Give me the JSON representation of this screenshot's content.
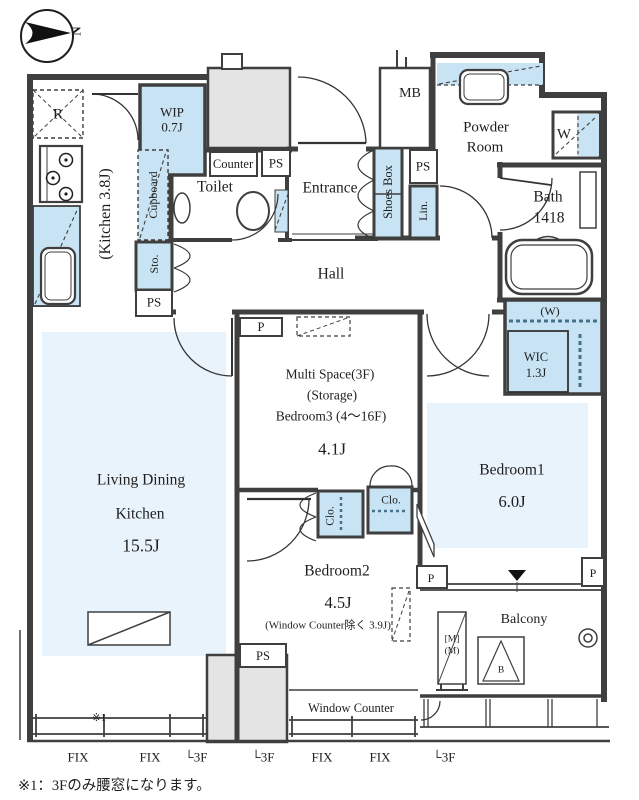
{
  "colors": {
    "wall": "#3f3f3f",
    "fixture_fill": "#c8e4f4",
    "room_fill": "#e9f3fb",
    "exterior_fill": "#e4e4e4",
    "bold_dash": "#46718a"
  },
  "compass": {
    "north_label": "N"
  },
  "labels": {
    "refrigerator": "R",
    "wip_name": "WIP",
    "wip_area": "0.7J",
    "kitchen": "(Kitchen 3.8J)",
    "cupboard": "Cupboard",
    "counter": "Counter",
    "ps_top": "PS",
    "ps_entrance": "PS",
    "ps_hall": "PS",
    "ps_bottom": "PS",
    "toilet": "Toilet",
    "entrance": "Entrance",
    "shoes_box": "Shoes Box",
    "mb": "MB",
    "powder_line1": "Powder",
    "powder_line2": "Room",
    "lin": "Lin.",
    "bath_name": "Bath",
    "bath_size": "1418",
    "washer": "W",
    "hall": "Hall",
    "sto": "Sto.",
    "p_multi": "P",
    "p_balcony_left": "P",
    "p_balcony_right": "P",
    "multi_line1": "Multi Space(3F)",
    "multi_line2": "(Storage)",
    "multi_line3": "Bedroom3 (4〜16F)",
    "multi_area": "4.1J",
    "wic_w": "(W)",
    "wic_name": "WIC",
    "wic_area": "1.3J",
    "bedroom1_name": "Bedroom1",
    "bedroom1_area": "6.0J",
    "ldk_line1": "Living Dining",
    "ldk_line2": "Kitchen",
    "ldk_area": "15.5J",
    "bedroom2_name": "Bedroom2",
    "bedroom2_area": "4.5J",
    "bedroom2_note": "(Window Counter除く 3.9J)",
    "clo_left": "Clo.",
    "clo_right": "Clo.",
    "window_counter": "Window Counter",
    "balcony": "Balcony",
    "meter_line1": "[M]",
    "meter_line2": "(M)",
    "b_mark": "B",
    "marker_note": "※1"
  },
  "windows": [
    "FIX",
    "FIX",
    "└3F",
    "└3F",
    "FIX",
    "FIX",
    "└3F"
  ],
  "footnote": "※1：3Fのみ腰窓になります。"
}
